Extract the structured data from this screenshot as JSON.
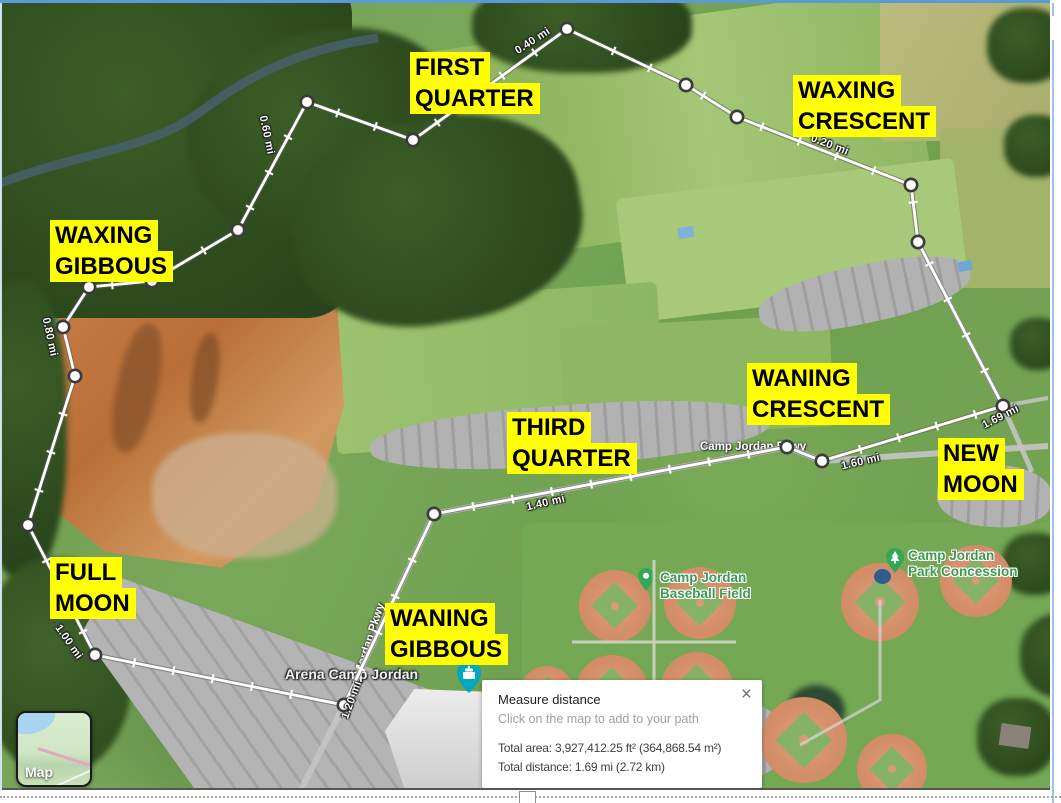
{
  "annotations": {
    "highlight_color": "#ffff00",
    "text_color": "#000000",
    "moon_phases": [
      {
        "id": "first-quarter",
        "lines": [
          "FIRST",
          "QUARTER"
        ]
      },
      {
        "id": "waxing-crescent",
        "lines": [
          "WAXING",
          "CRESCENT"
        ]
      },
      {
        "id": "waxing-gibbous",
        "lines": [
          "WAXING",
          "GIBBOUS"
        ]
      },
      {
        "id": "waning-crescent",
        "lines": [
          "WANING",
          "CRESCENT"
        ]
      },
      {
        "id": "new-moon",
        "lines": [
          "NEW",
          "MOON"
        ]
      },
      {
        "id": "third-quarter",
        "lines": [
          "THIRD",
          "QUARTER"
        ]
      },
      {
        "id": "full-moon",
        "lines": [
          "FULL",
          "MOON"
        ]
      },
      {
        "id": "waning-gibbous",
        "lines": [
          "WANING",
          "GIBBOUS"
        ]
      }
    ]
  },
  "measure_tool": {
    "panel": {
      "title": "Measure distance",
      "hint": "Click on the map to add to your path",
      "total_area": "Total area: 3,927,412.25 ft² (364,868.54 m²)",
      "total_distance": "Total distance: 1.69 mi (2.72 km)",
      "close_icon": "×"
    },
    "distance_markers": [
      "0.20 mi",
      "0.40 mi",
      "0.60 mi",
      "0.80 mi",
      "1.00 mi",
      "1.20 mi",
      "1.40 mi",
      "1.60 mi",
      "1.69 mi"
    ],
    "path_points": [
      [
        1003,
        406
      ],
      [
        918,
        242
      ],
      [
        911,
        185
      ],
      [
        737,
        117
      ],
      [
        686,
        85
      ],
      [
        567,
        29
      ],
      [
        413,
        140
      ],
      [
        307,
        102
      ],
      [
        238,
        230
      ],
      [
        152,
        281
      ],
      [
        89,
        287
      ],
      [
        63,
        327
      ],
      [
        75,
        376
      ],
      [
        28,
        525
      ],
      [
        95,
        655
      ],
      [
        344,
        705
      ],
      [
        434,
        514
      ],
      [
        787,
        447
      ],
      [
        822,
        461
      ],
      [
        1003,
        406
      ]
    ],
    "path_color": "#ffffff"
  },
  "map": {
    "places": [
      {
        "lines": [
          "Camp Jordan",
          "Baseball Field"
        ],
        "icon": "place-pin"
      },
      {
        "lines": [
          "Camp Jordan",
          "Park Concession"
        ],
        "icon": "tree-pin"
      },
      {
        "lines": [
          "Arena Camp Jordan"
        ],
        "icon": "arena-pin"
      }
    ],
    "roads": [
      {
        "label": "Camp Jordan Pkwy"
      },
      {
        "label": "Camp Jordan Pkwy"
      }
    ],
    "controls": {
      "map_toggle_label": "Map"
    },
    "colors": {
      "place_label_green": "#3d9a50",
      "pin_green": "#34a853",
      "arena_marker_teal": "#00a8c0"
    }
  }
}
